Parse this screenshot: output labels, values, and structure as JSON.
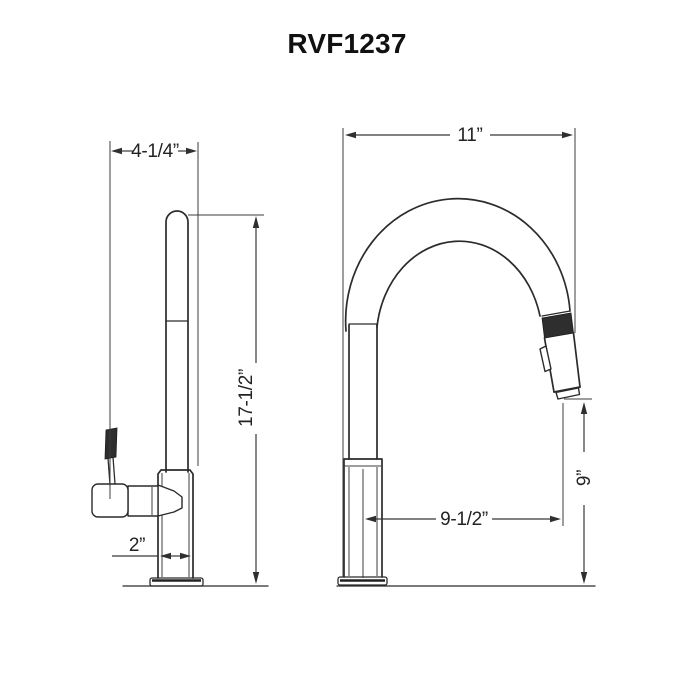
{
  "title": "RVF1237",
  "colors": {
    "line": "#2b2b2b",
    "dimension_line": "#383838",
    "background": "#ffffff",
    "grip_fill": "#2e2e2e"
  },
  "views": {
    "side": {
      "dimensions": {
        "top_width": "4-1/4”",
        "overall_height": "17-1/2”",
        "base_width": "2”"
      }
    },
    "front": {
      "dimensions": {
        "overall_width": "11”",
        "spout_reach": "9-1/2”",
        "spray_clearance": "9”"
      }
    }
  }
}
